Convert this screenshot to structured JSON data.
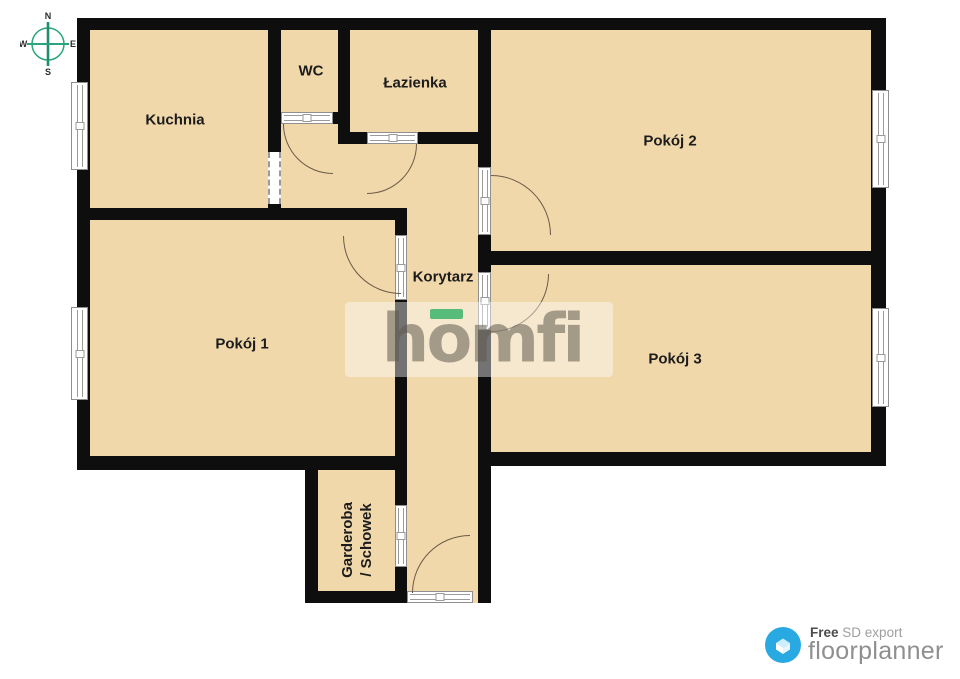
{
  "compass": {
    "n": "N",
    "e": "E",
    "s": "S",
    "w": "W"
  },
  "rooms": {
    "kuchnia": {
      "label": "Kuchnia"
    },
    "wc": {
      "label": "WC"
    },
    "lazienka": {
      "label": "Łazienka"
    },
    "pokoj1": {
      "label": "Pokój 1"
    },
    "pokoj2": {
      "label": "Pokój 2"
    },
    "pokoj3": {
      "label": "Pokój 3"
    },
    "korytarz": {
      "label": "Korytarz"
    },
    "garderoba": {
      "label_line1": "Garderoba",
      "label_line2": "/ Schowek"
    }
  },
  "watermark": {
    "brand": "homfi"
  },
  "footer": {
    "free_label": "Free",
    "export_label": "SD export",
    "brand": "floorplanner"
  },
  "colors": {
    "floor": "#f0d8ab",
    "wall": "#0e0e0e",
    "outside": "#ffffff",
    "door_arc": "#6b5b48",
    "compass_green": "#2aa47e",
    "accent_green": "#57bb7a",
    "brand_blue": "#29a9e1"
  }
}
